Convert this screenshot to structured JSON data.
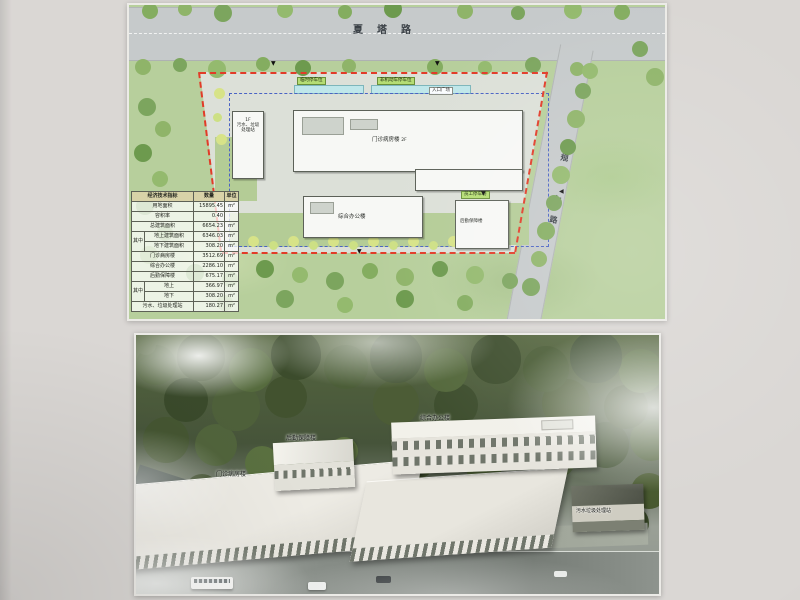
{
  "site_plan": {
    "roads": {
      "top_road": "夏塔路",
      "right_road_chars": [
        "规",
        "划",
        "七",
        "路"
      ]
    },
    "buildings": {
      "outpatient": {
        "name": "门诊病房楼",
        "floors": "2F"
      },
      "office": {
        "name": "综合办公楼"
      },
      "logistics": {
        "name": "后勤保障楼"
      },
      "sewage": {
        "name": "污水、垃圾处理站",
        "floors": "1F"
      }
    },
    "tags": {
      "temp_parking": "临时停车位",
      "bike_parking": "非机动车停车位",
      "entry_plaza": "入口广场",
      "staff_parking": "员工停车场"
    },
    "table": {
      "headers": [
        "经济技术指标",
        "数量",
        "单位"
      ],
      "group_label": "其中",
      "rows": [
        {
          "label": "用地面积",
          "value": "15895.45",
          "unit": "m²"
        },
        {
          "label": "容积率",
          "value": "0.40",
          "unit": ""
        },
        {
          "label": "总建筑面积",
          "value": "6654.23",
          "unit": "m²"
        },
        {
          "label": "地上建筑面积",
          "value": "6346.03",
          "unit": "m²"
        },
        {
          "label": "地下建筑面积",
          "value": "308.20",
          "unit": "m²"
        },
        {
          "label": "门诊病房楼",
          "value": "3512.69",
          "unit": "m²"
        },
        {
          "label": "综合办公楼",
          "value": "2286.10",
          "unit": "m²"
        },
        {
          "label": "后勤保障楼",
          "value": "675.17",
          "unit": "m²"
        },
        {
          "label": "地上",
          "value": "366.97",
          "unit": "m²"
        },
        {
          "label": "地下",
          "value": "308.20",
          "unit": "m²"
        },
        {
          "label": "污水、垃圾处理站",
          "value": "180.27",
          "unit": "m²"
        }
      ]
    },
    "icons": {
      "entrance_marker_down": "▼",
      "entrance_marker_left": "◀"
    },
    "colors": {
      "boundary_red": "#e23b28",
      "setback_blue": "#4a63c4",
      "grass_green": "#b7cf9c",
      "road_gray": "#c6cacb",
      "tag_green": "#b5dd74"
    }
  },
  "rendering": {
    "labels": {
      "outpatient": "门诊病房楼",
      "office": "综合办公楼",
      "logistics": "后勤保障楼",
      "sewage": "污水垃圾处理站"
    }
  }
}
